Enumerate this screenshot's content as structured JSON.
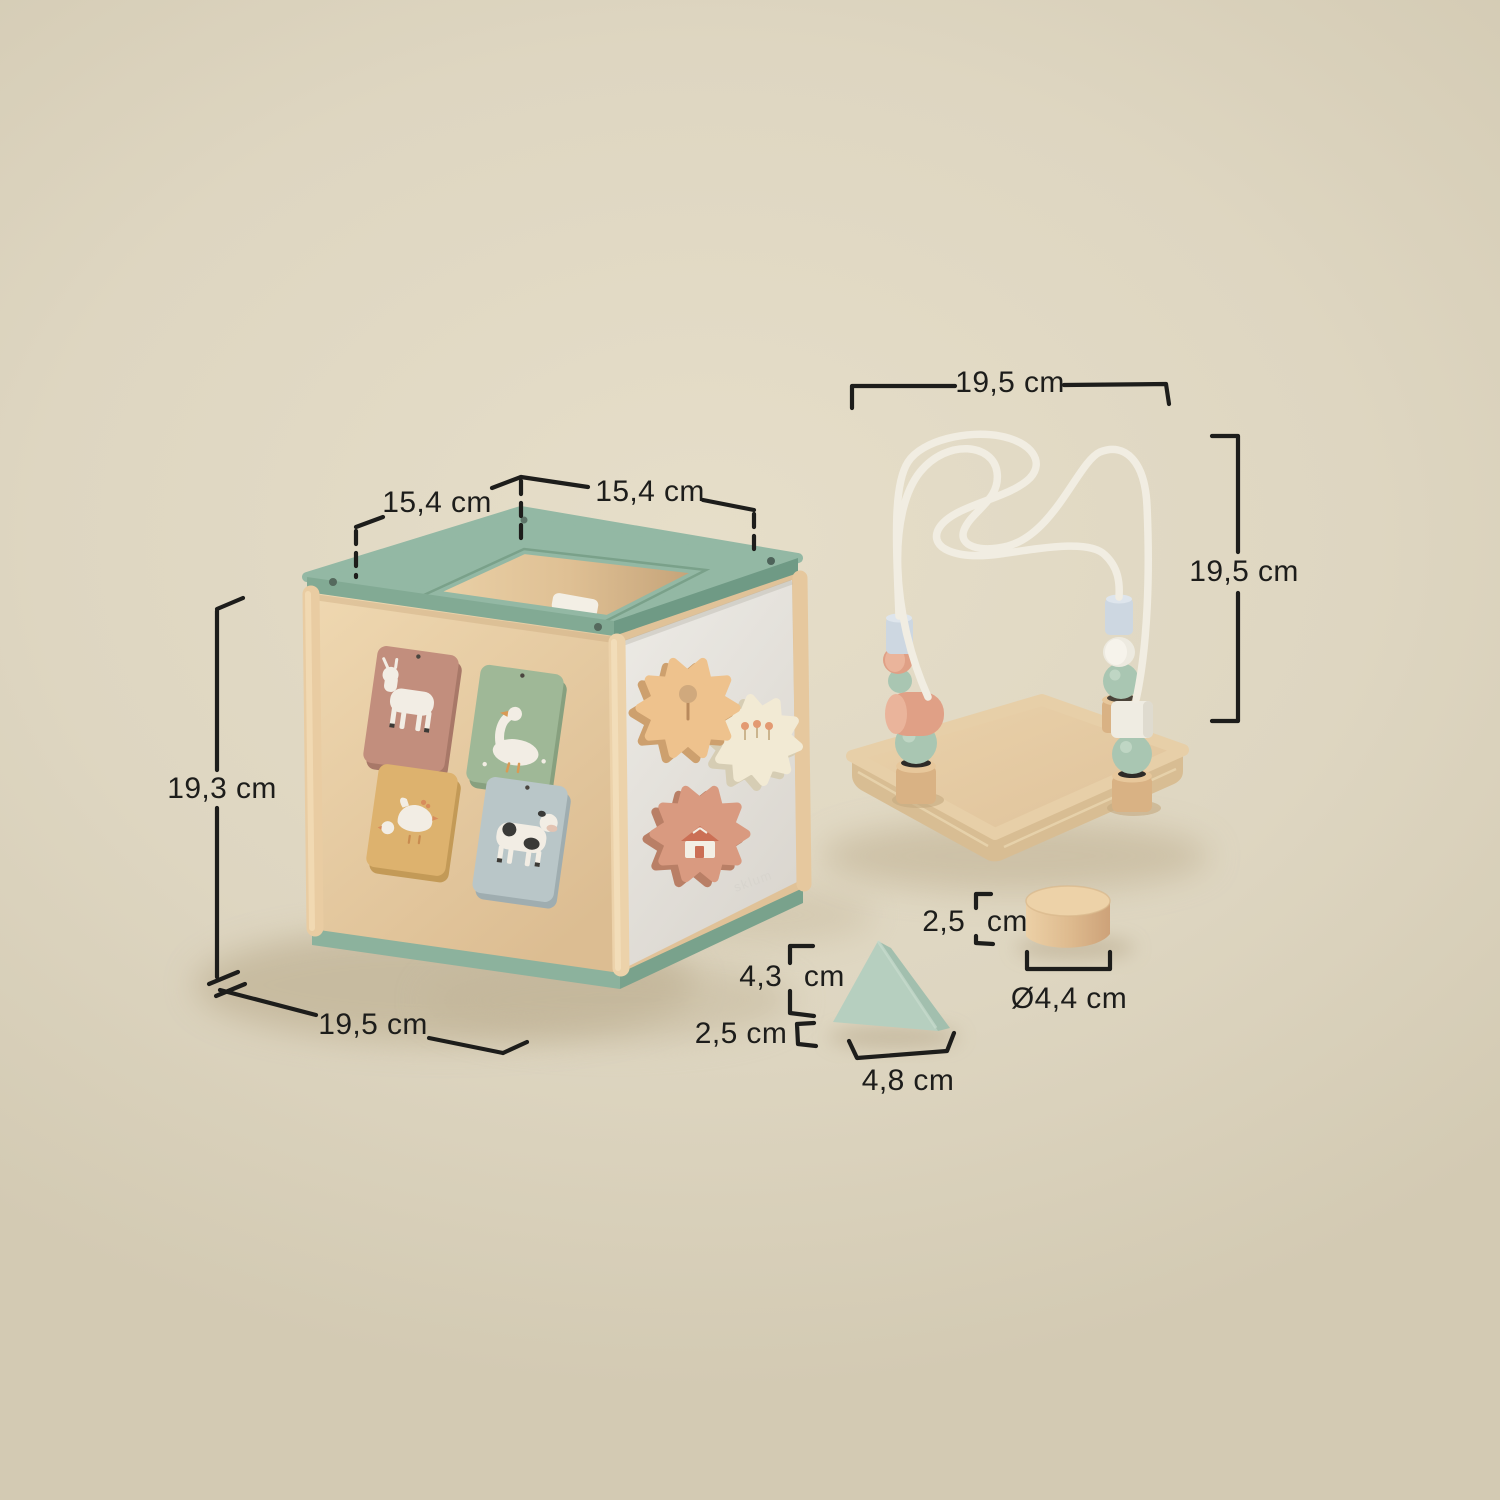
{
  "watermark": "sklum",
  "dimensions": {
    "cube_top_left": "15,4 cm",
    "cube_top_right": "15,4 cm",
    "cube_height": "19,3 cm",
    "cube_depth": "19,5 cm",
    "maze_width": "19,5 cm",
    "maze_height": "19,5 cm",
    "triangle_height": "4,3 cm",
    "triangle_depth": "2,5 cm",
    "triangle_width": "4,8 cm",
    "cylinder_height": "2,5 cm",
    "cylinder_diameter": "Ø4,4 cm"
  },
  "colors": {
    "background": "#ded6c1",
    "dimension_line": "#1d1d1b",
    "wood": "#e6c89c",
    "trim_green": "#93b8a4",
    "panel_gray": "#e9e7e2",
    "tile_rose": "#c28e7d",
    "tile_sage": "#9fb897",
    "tile_ochre": "#ddb26e",
    "tile_blue": "#b9c6c8",
    "gear_peach": "#eec28d",
    "gear_cream": "#f2ead4",
    "gear_salmon": "#d99a80",
    "bead_blue": "#cdd7e1",
    "bead_sage": "#a9c6b2",
    "bead_salmon": "#e0a086",
    "triangle_mint": "#b6cfbf",
    "wire_white": "#f1ede2"
  }
}
